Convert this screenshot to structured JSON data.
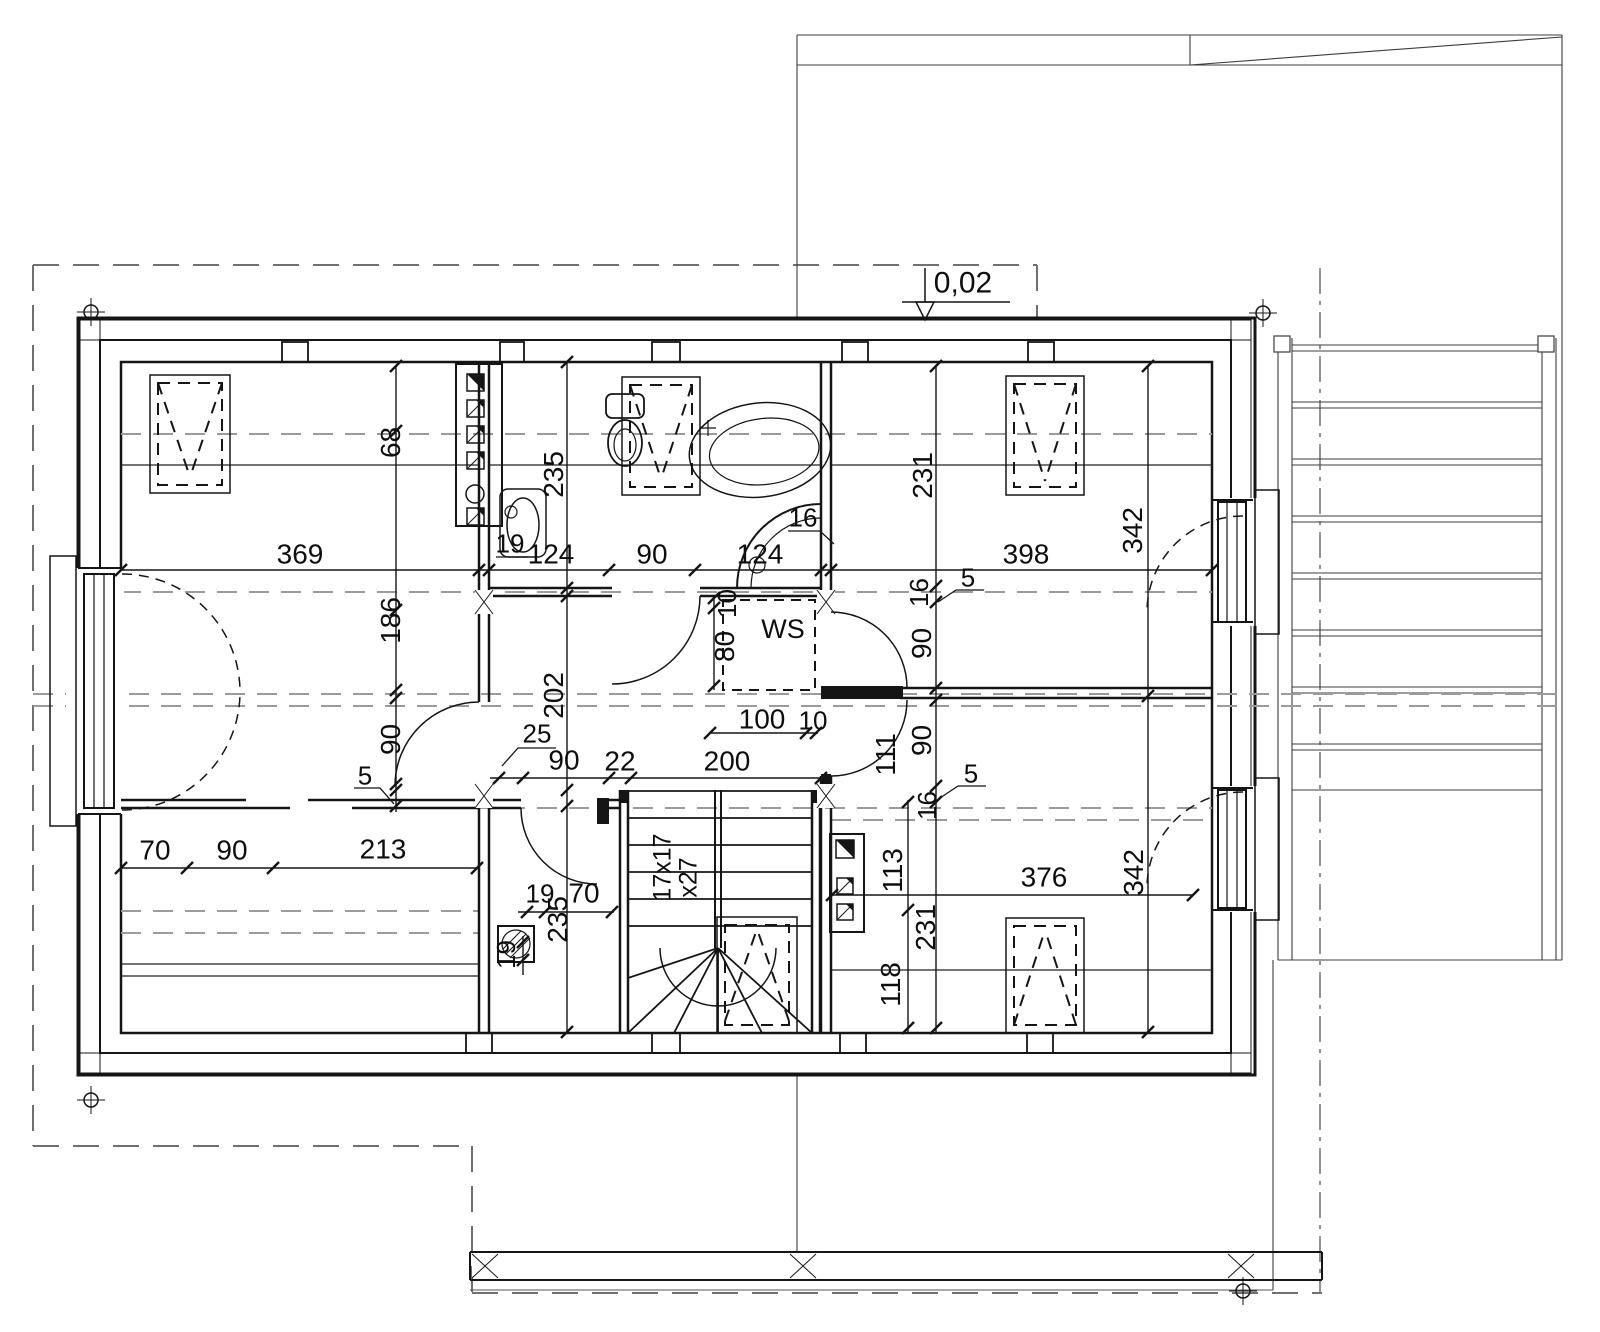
{
  "drawing": {
    "kind": "architectural-floor-plan-upper-storey",
    "background": "#ffffff",
    "ink": "#151515",
    "roofline_grey": "#9b9b9b"
  },
  "labels": [
    {
      "name": "level-label",
      "text": "0,02",
      "x": 963,
      "y": 284,
      "rot": 0,
      "fs": 30
    },
    {
      "name": "dim-369",
      "text": "369",
      "x": 300,
      "y": 555,
      "rot": 0,
      "fs": 28
    },
    {
      "name": "dim-124a",
      "text": "124",
      "x": 551,
      "y": 555,
      "rot": 0,
      "fs": 28
    },
    {
      "name": "dim-90a",
      "text": "90",
      "x": 652,
      "y": 555,
      "rot": 0,
      "fs": 28
    },
    {
      "name": "dim-124b",
      "text": "124",
      "x": 760,
      "y": 555,
      "rot": 0,
      "fs": 28
    },
    {
      "name": "dim-398",
      "text": "398",
      "x": 1026,
      "y": 555,
      "rot": 0,
      "fs": 28
    },
    {
      "name": "dim-19wc",
      "text": "19",
      "x": 510,
      "y": 544,
      "rot": 0,
      "fs": 26
    },
    {
      "name": "dim-16shower",
      "text": "16",
      "x": 803,
      "y": 518,
      "rot": 0,
      "fs": 26
    },
    {
      "name": "dim-235a",
      "text": "235",
      "x": 554,
      "y": 475,
      "rot": -90,
      "fs": 28
    },
    {
      "name": "dim-68",
      "text": "68",
      "x": 391,
      "y": 443,
      "rot": -90,
      "fs": 28
    },
    {
      "name": "dim-186",
      "text": "186",
      "x": 391,
      "y": 621,
      "rot": -90,
      "fs": 28
    },
    {
      "name": "dim-90left",
      "text": "90",
      "x": 391,
      "y": 740,
      "rot": -90,
      "fs": 28
    },
    {
      "name": "dim-5left",
      "text": "5",
      "x": 365,
      "y": 776,
      "rot": 0,
      "fs": 26
    },
    {
      "name": "dim-231a",
      "text": "231",
      "x": 923,
      "y": 476,
      "rot": -90,
      "fs": 28
    },
    {
      "name": "dim-342a",
      "text": "342",
      "x": 1133,
      "y": 531,
      "rot": -90,
      "fs": 28
    },
    {
      "name": "dim-16a",
      "text": "16",
      "x": 919,
      "y": 593,
      "rot": -90,
      "fs": 26
    },
    {
      "name": "dim-5a",
      "text": "5",
      "x": 968,
      "y": 578,
      "rot": 0,
      "fs": 26
    },
    {
      "name": "dim-90b",
      "text": "90",
      "x": 922,
      "y": 644,
      "rot": -90,
      "fs": 28
    },
    {
      "name": "closet-label",
      "text": "WS",
      "x": 783,
      "y": 630,
      "rot": 0,
      "fs": 27
    },
    {
      "name": "dim-10ws",
      "text": "10",
      "x": 727,
      "y": 604,
      "rot": -90,
      "fs": 26
    },
    {
      "name": "dim-80",
      "text": "80",
      "x": 725,
      "y": 647,
      "rot": -90,
      "fs": 28
    },
    {
      "name": "dim-100",
      "text": "100",
      "x": 762,
      "y": 720,
      "rot": 0,
      "fs": 28
    },
    {
      "name": "dim-10b",
      "text": "10",
      "x": 813,
      "y": 721,
      "rot": 0,
      "fs": 26
    },
    {
      "name": "dim-202",
      "text": "202",
      "x": 554,
      "y": 696,
      "rot": -90,
      "fs": 28
    },
    {
      "name": "dim-25",
      "text": "25",
      "x": 537,
      "y": 734,
      "rot": 0,
      "fs": 26
    },
    {
      "name": "dim-90c",
      "text": "90",
      "x": 564,
      "y": 761,
      "rot": 0,
      "fs": 28
    },
    {
      "name": "dim-22",
      "text": "22",
      "x": 620,
      "y": 762,
      "rot": 0,
      "fs": 28
    },
    {
      "name": "dim-200",
      "text": "200",
      "x": 727,
      "y": 762,
      "rot": 0,
      "fs": 28
    },
    {
      "name": "dim-111",
      "text": "111",
      "x": 886,
      "y": 755,
      "rot": -90,
      "fs": 28
    },
    {
      "name": "dim-90d",
      "text": "90",
      "x": 922,
      "y": 741,
      "rot": -90,
      "fs": 28
    },
    {
      "name": "dim-5b",
      "text": "5",
      "x": 971,
      "y": 774,
      "rot": 0,
      "fs": 26
    },
    {
      "name": "dim-16b",
      "text": "16",
      "x": 927,
      "y": 806,
      "rot": -90,
      "fs": 26
    },
    {
      "name": "dim-70a",
      "text": "70",
      "x": 155,
      "y": 851,
      "rot": 0,
      "fs": 28
    },
    {
      "name": "dim-90e",
      "text": "90",
      "x": 232,
      "y": 851,
      "rot": 0,
      "fs": 28
    },
    {
      "name": "dim-213",
      "text": "213",
      "x": 383,
      "y": 850,
      "rot": 0,
      "fs": 28
    },
    {
      "name": "dim-19a",
      "text": "19",
      "x": 540,
      "y": 894,
      "rot": 0,
      "fs": 26
    },
    {
      "name": "dim-70b",
      "text": "70",
      "x": 584,
      "y": 894,
      "rot": 0,
      "fs": 28
    },
    {
      "name": "dim-235b",
      "text": "235",
      "x": 558,
      "y": 920,
      "rot": -90,
      "fs": 28
    },
    {
      "name": "dim-19b",
      "text": "19",
      "x": 506,
      "y": 955,
      "rot": -90,
      "fs": 26
    },
    {
      "name": "stair-riser-label",
      "text": "17x17",
      "x": 663,
      "y": 868,
      "rot": -90,
      "fs": 25
    },
    {
      "name": "stair-going-label",
      "text": "x27",
      "x": 689,
      "y": 878,
      "rot": -90,
      "fs": 25
    },
    {
      "name": "dim-113",
      "text": "113",
      "x": 893,
      "y": 871,
      "rot": -90,
      "fs": 28
    },
    {
      "name": "dim-231b",
      "text": "231",
      "x": 926,
      "y": 928,
      "rot": -90,
      "fs": 28
    },
    {
      "name": "dim-118",
      "text": "118",
      "x": 891,
      "y": 985,
      "rot": -90,
      "fs": 28
    },
    {
      "name": "dim-376",
      "text": "376",
      "x": 1044,
      "y": 878,
      "rot": 0,
      "fs": 28
    },
    {
      "name": "dim-342b",
      "text": "342",
      "x": 1134,
      "y": 873,
      "rot": -90,
      "fs": 28
    }
  ]
}
